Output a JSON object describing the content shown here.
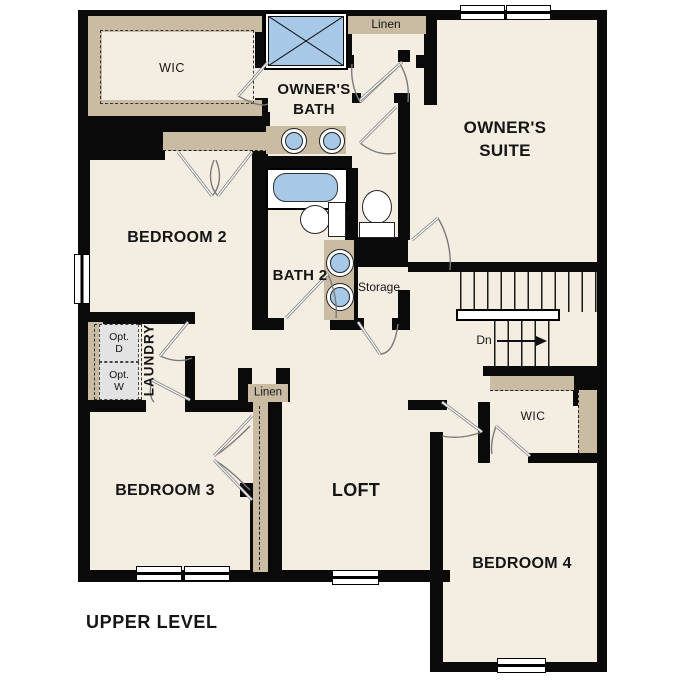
{
  "plan": {
    "title": "UPPER LEVEL",
    "labels": {
      "owners_suite": "OWNER'S\nSUITE",
      "owners_bath": "OWNER'S\nBATH",
      "wic_owner": "WIC",
      "wic_bedroom4": "WIC",
      "bedroom2": "BEDROOM 2",
      "bedroom3": "BEDROOM 3",
      "bedroom4": "BEDROOM 4",
      "bath2": "BATH 2",
      "loft": "LOFT",
      "laundry": "LAUNDRY",
      "linen_upper": "Linen",
      "linen_hall": "Linen",
      "storage": "Storage",
      "stairs_down": "Dn",
      "opt_dryer": "Opt.\nD",
      "opt_washer": "Opt.\nW"
    },
    "colors": {
      "floor": "#f4eee2",
      "wall": "#0a0a0a",
      "closet_shelf": "#c9bca3",
      "fixture_blue": "#a8c8e8",
      "appliance_gray": "#e3e3e3",
      "door_swing_gray": "#8a8a8a"
    }
  }
}
